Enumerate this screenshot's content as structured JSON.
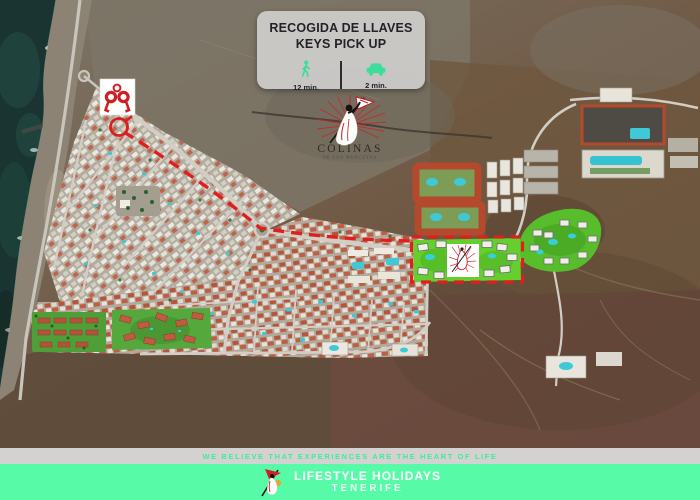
{
  "info_box": {
    "title_es": "RECOGIDA DE LLAVES",
    "title_en": "KEYS PICK UP",
    "walk_time": "12 min.",
    "drive_time": "2 min.",
    "icons": {
      "walk": "walking-person-icon",
      "drive": "car-icon"
    }
  },
  "map": {
    "type": "satellite-aerial-photo",
    "logo": {
      "name": "COLINAS",
      "subtitle": "DE LOS MENCEYES"
    },
    "markers": [
      {
        "name": "keys-pickup-marker",
        "icon": "keys-icon"
      },
      {
        "name": "route-start-circle",
        "style": "red-outline-circle"
      },
      {
        "name": "route",
        "style": "red-dashed-line"
      },
      {
        "name": "resort-highlight",
        "style": "red-dashed-rectangle"
      }
    ]
  },
  "footer": {
    "tagline": "WE BELIEVE THAT EXPERIENCES ARE THE HEART OF LIFE",
    "brand_line1": "LIFESTYLE HOLIDAYS",
    "brand_line2": "TENERIFE",
    "logo": "flamenco-dancer-icon"
  },
  "colors": {
    "accent_green": "#3EDD9B",
    "footer_green": "#57FBA7",
    "tagline_green": "#45E89C",
    "brand_red": "#D02025",
    "route_red": "#E11E1E",
    "info_box_bg": "#CAC9C7",
    "highlight_green": "#65CF2E",
    "ocean_teal": "#1A3531"
  }
}
